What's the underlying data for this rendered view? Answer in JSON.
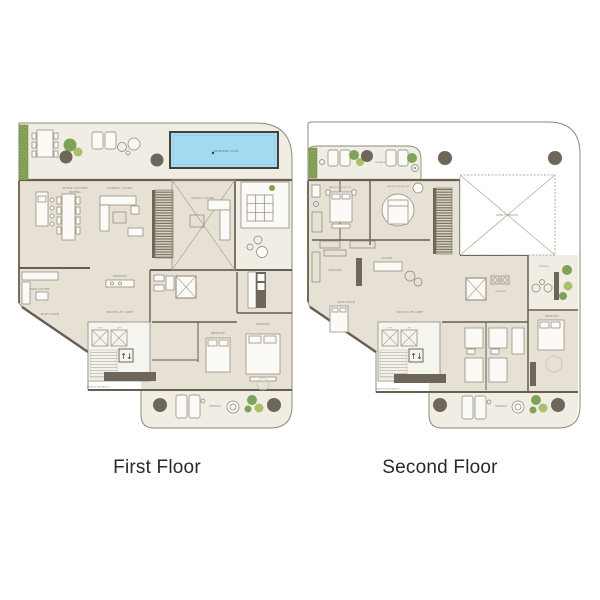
{
  "titles": {
    "first": "First Floor",
    "second": "Second Floor"
  },
  "symbols": {
    "lift_updown": "↑↓"
  },
  "colors": {
    "background": "#ffffff",
    "floor_beige": "#e6e1d4",
    "terrace_cream": "#f0ede5",
    "core_light": "#f6f4ee",
    "wall": "#665f4e",
    "outline": "#8f897b",
    "pool_water": "#a3daf2",
    "pool_border": "#44413a",
    "plant_green": "#7da356",
    "plant_green_light": "#a9c16d",
    "column_gray": "#6e6759",
    "title_text": "#252a33",
    "room_label": "#8c8475"
  },
  "floor1": {
    "rooms": {
      "show_kitchen_line1": "SHOW KITCHEN",
      "show_kitchen_line2": "DINING",
      "formal_living": "FORMAL LIVING",
      "family_living": "FAMILY LIVING",
      "swimming_pool": "SWIMMING POOL",
      "main_kitchen": "MAIN KITCHEN",
      "maids_room": "MAID'S ROOM",
      "entrance": "ENTRANCE",
      "private_lift_lobby": "PRIVATE LIFT LOBBY",
      "lift_a": "LIFT",
      "lift_b": "LIFT",
      "bedroom_mid": "BEDROOM",
      "bedroom_right": "BEDROOM",
      "terrace_bottom": "TERRACE",
      "service_entrance": "SERVICE ENTRANCE"
    }
  },
  "floor2": {
    "rooms": {
      "terrace_top": "TERRACE",
      "master_bedroom_1": "MASTER BEDROOM",
      "master_bedroom_2": "MASTER BEDROOM",
      "open_to_below": "OPEN TO BELOW",
      "dressing": "DRESSING",
      "lounge": "LOUNGE",
      "guest_room": "GUEST ROOM",
      "laundry": "LAUNDRY",
      "private_lift_lobby": "PRIVATE LIFT LOBBY",
      "lift_a": "LIFT",
      "lift_b": "LIFT",
      "terrace_right": "TERRACE",
      "bedroom_right": "BEDROOM",
      "terrace_bottom": "TERRACE",
      "service_entrance": "SERVICE ENTRANCE"
    }
  }
}
